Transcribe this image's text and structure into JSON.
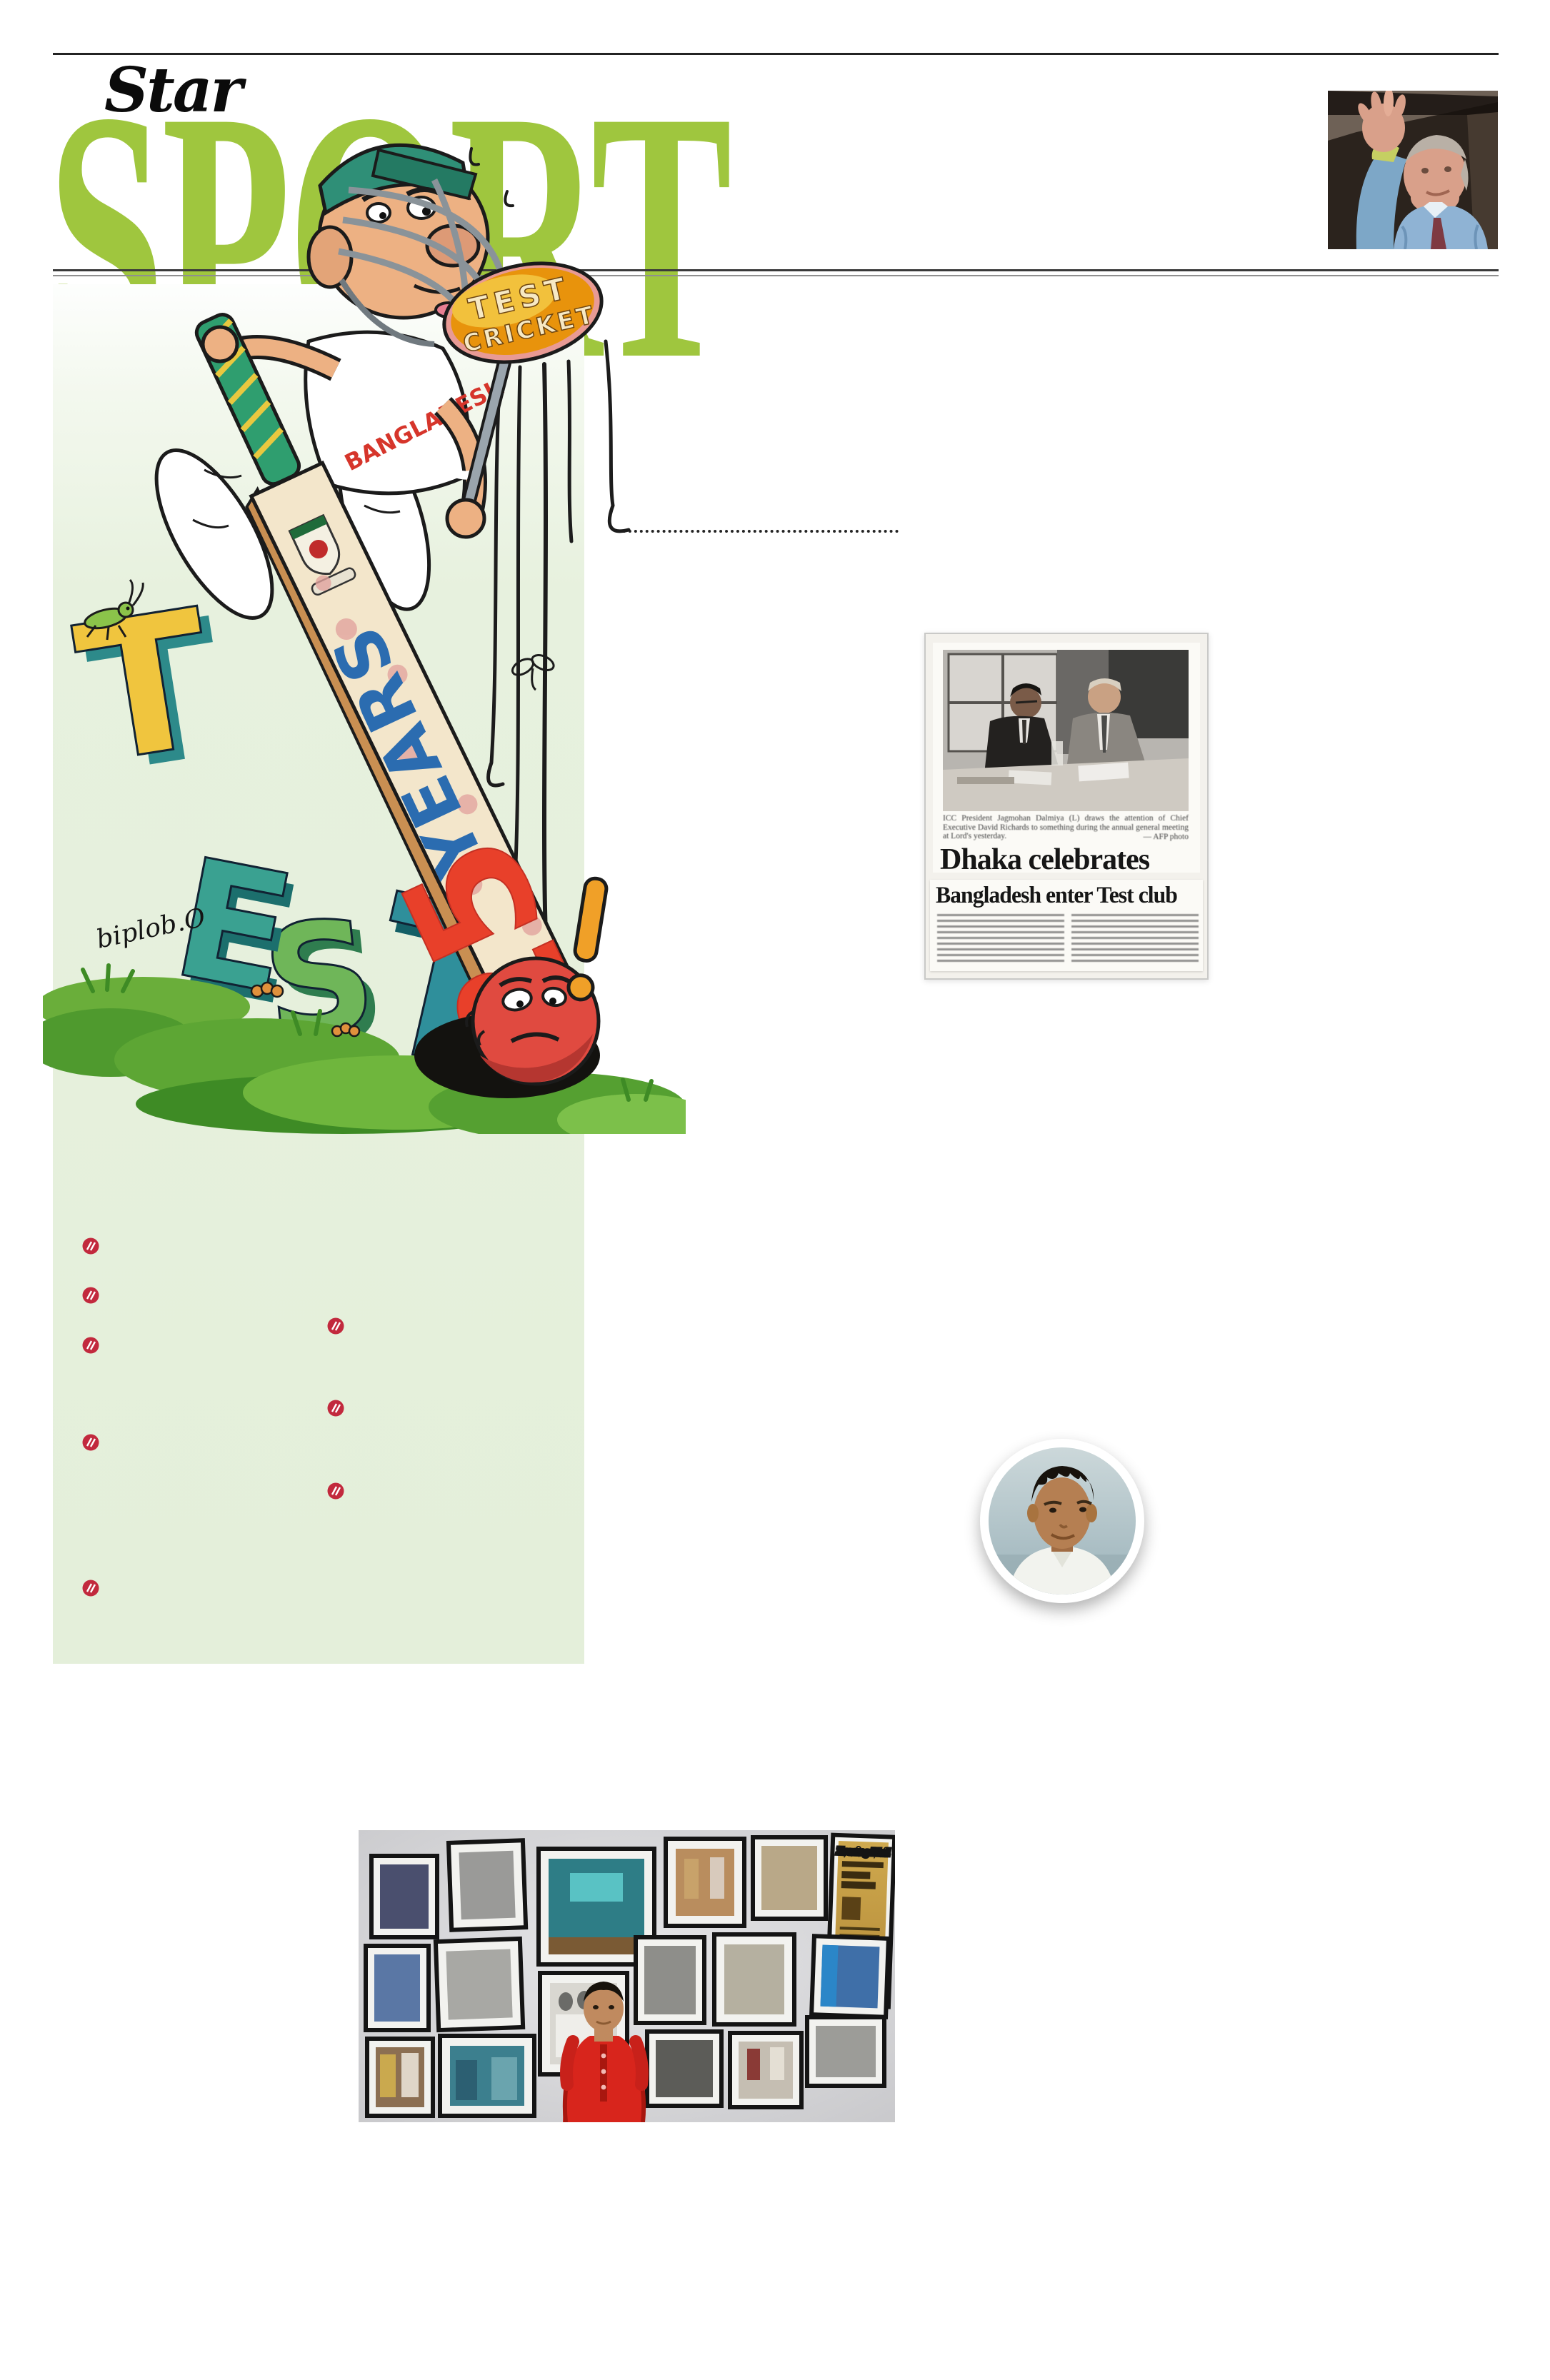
{
  "masthead": {
    "brand": "Star",
    "title": "SPORT"
  },
  "cartoon": {
    "lollipop_top": "TEST",
    "lollipop_bottom": "CRICKET",
    "jersey": "BANGLADESH",
    "letters": [
      "T",
      "E",
      "S",
      "T"
    ],
    "bat_number": "25",
    "bat_word": "YEARS",
    "signature": "biplob.O",
    "exclamation": "!"
  },
  "clipping": {
    "caption_line": "ICC President Jagmohan Dalmiya (L) draws the attention of Chief Executive David Richards to something during the annual general meeting at Lord's yesterday.",
    "photo_credit": "— AFP photo",
    "headline_main": "Dhaka celebrates",
    "headline_secondary": "Bangladesh enter Test club"
  },
  "wall_photo": {
    "newspaper_title": "Evening Mail"
  },
  "colors": {
    "accent_green": "#9fc63e",
    "panel_green": "#e4efda",
    "bullet_red": "#c2293d",
    "bat_number_red": "#e8402a",
    "bat_word_blue": "#2b6cb0",
    "cap_teal": "#2f8f77"
  }
}
